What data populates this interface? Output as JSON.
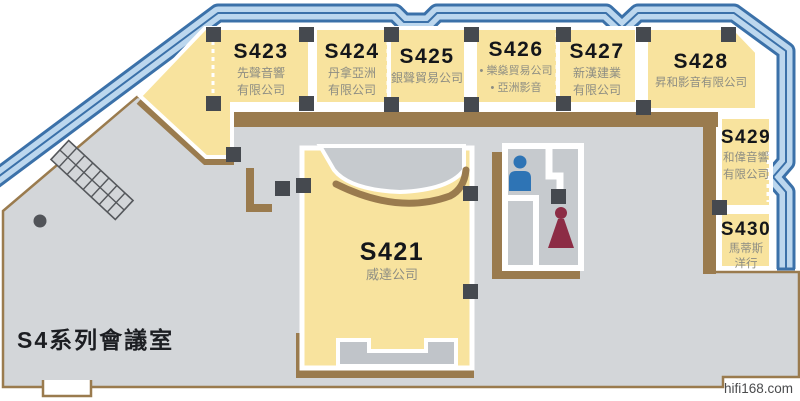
{
  "title": "S4系列會議室",
  "watermark": "hifi168.com",
  "booths": {
    "s421": {
      "id": "S421",
      "name1": "威達公司",
      "name2": ""
    },
    "s423": {
      "id": "S423",
      "name1": "先聲音響",
      "name2": "有限公司"
    },
    "s424": {
      "id": "S424",
      "name1": "丹拿亞洲",
      "name2": "有限公司"
    },
    "s425": {
      "id": "S425",
      "name1": "銀聲貿易公司",
      "name2": ""
    },
    "s426": {
      "id": "S426",
      "name1": "• 樂燊貿易公司",
      "name2": "• 亞洲影音"
    },
    "s427": {
      "id": "S427",
      "name1": "新漢建業",
      "name2": "有限公司"
    },
    "s428": {
      "id": "S428",
      "name1": "昇和影音有限公司",
      "name2": ""
    },
    "s429": {
      "id": "S429",
      "name1": "和偉音響",
      "name2": "有限公司"
    },
    "s430": {
      "id": "S430",
      "name1": "馬蒂斯",
      "name2": "洋行"
    }
  },
  "legend": {
    "mens_room_icon": "male-figure",
    "womens_room_icon": "female-figure",
    "escalator_icon": "escalator-hatch",
    "pillar_icon": "column-square"
  },
  "colors": {
    "booth_yellow": "#F8E39E",
    "floor_gray": "#D3D6D9",
    "wall_brown": "#9A7B4E",
    "outer_wall_light_blue": "#BCD7EE",
    "outer_wall_dark_blue": "#3B71A9",
    "pillar_dark": "#45494F",
    "mens_blue": "#2E74B5",
    "womens_maroon": "#8C2C45"
  }
}
